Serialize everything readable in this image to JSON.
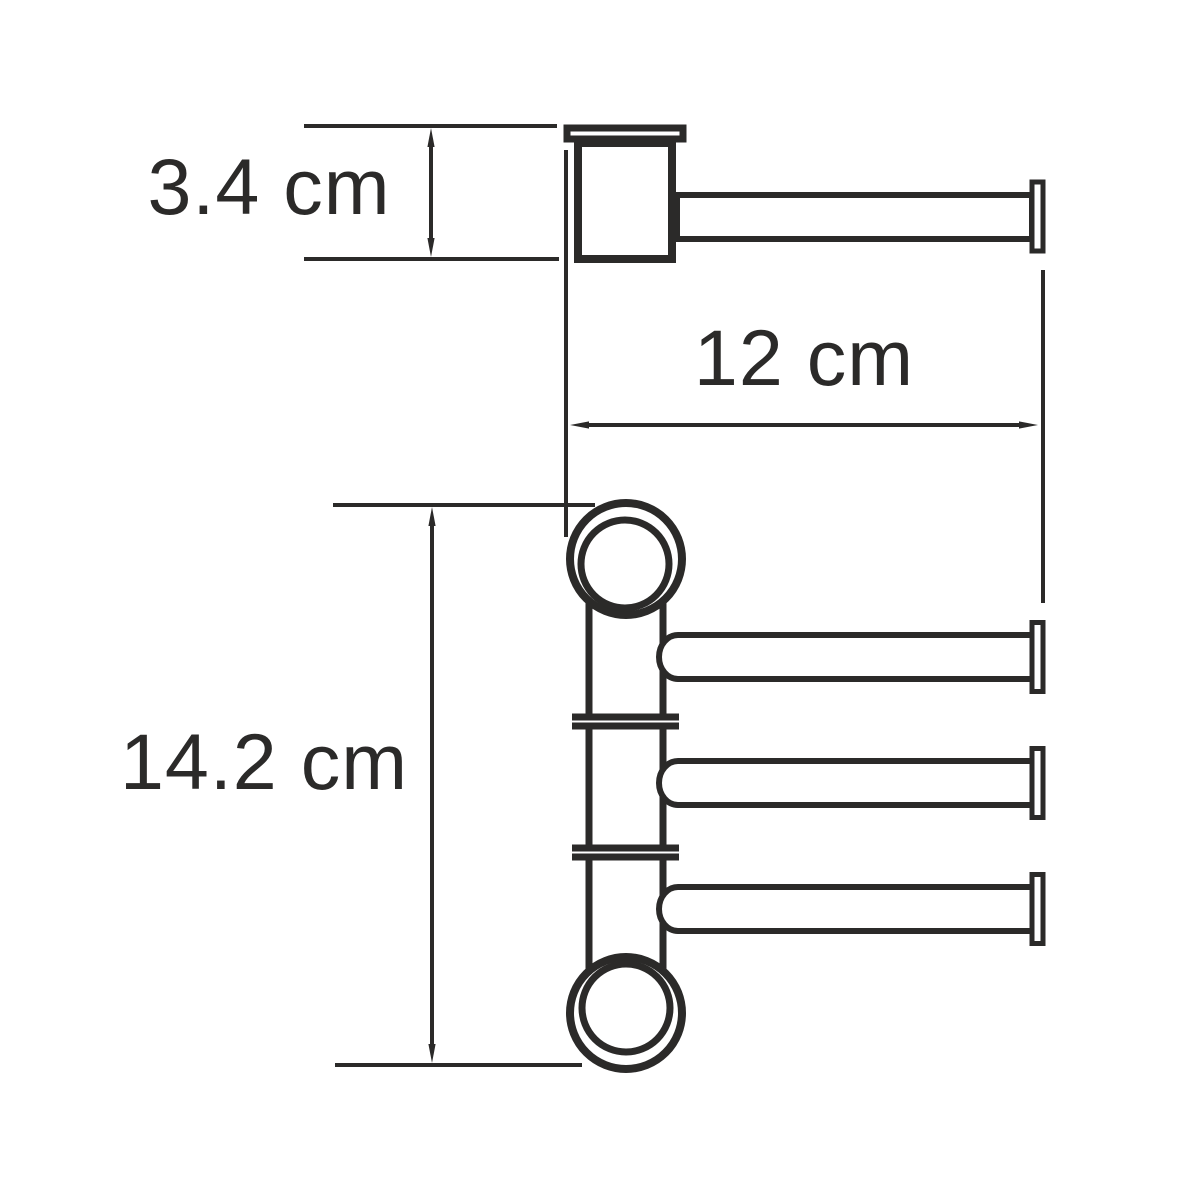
{
  "diagram": {
    "dimensions": {
      "mount_depth": "3.4 cm",
      "arm_length": "12 cm",
      "holder_height": "14.2 cm"
    },
    "colors": {
      "line": "#2b2a29",
      "background": "#ffffff"
    }
  }
}
